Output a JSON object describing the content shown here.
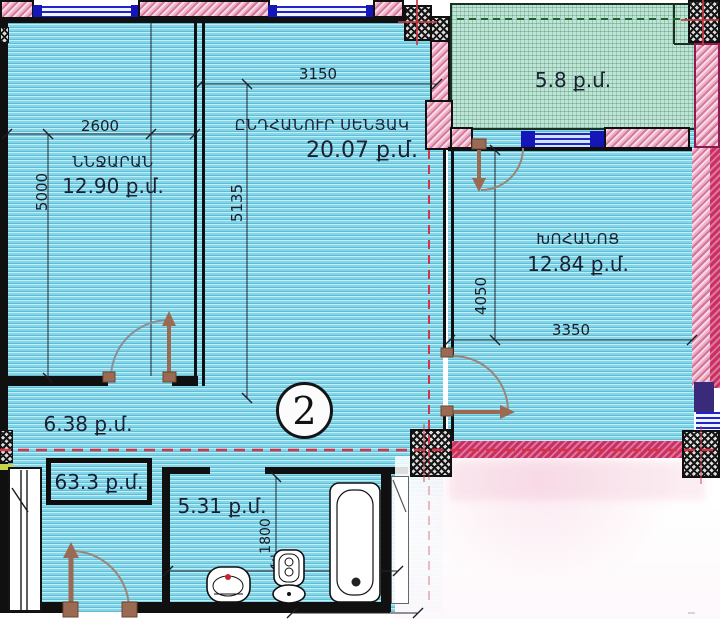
{
  "plan": {
    "unit_number": "2",
    "total_area": "63.3 ք.մ.",
    "rooms": {
      "bedroom": {
        "name": "ՆՆՋԱՐԱՆ",
        "area": "12.90 ք.մ."
      },
      "living_room": {
        "name": "ԸՆԴՀԱՆՈՒՐ ՍԵՆՅԱԿ",
        "area": "20.07 ք.մ."
      },
      "kitchen": {
        "name": "ԽՈՀԱՆՈՑ",
        "area": "12.84 ք.մ."
      },
      "balcony": {
        "area": "5.8 ք.մ."
      },
      "hallway": {
        "area": "6.38 ք.մ."
      },
      "bathroom": {
        "area": "5.31 ք.մ."
      }
    },
    "dims": {
      "bedroom_w": "2600",
      "bedroom_h": "5000",
      "living_w": "3150",
      "living_h": "5135",
      "kitchen_w": "3350",
      "kitchen_h": "4050",
      "bathroom_h": "1800",
      "bathroom_w": "3000"
    },
    "colors": {
      "floor": "#7ed7ea",
      "balcony_floor": "#bfe4da",
      "wall_pink": "#eeaec5",
      "wall_crimson": "#cb2e63",
      "window_blue": "#2323c8",
      "axis_red": "#d23448",
      "door_brown": "#9a6b52"
    }
  }
}
